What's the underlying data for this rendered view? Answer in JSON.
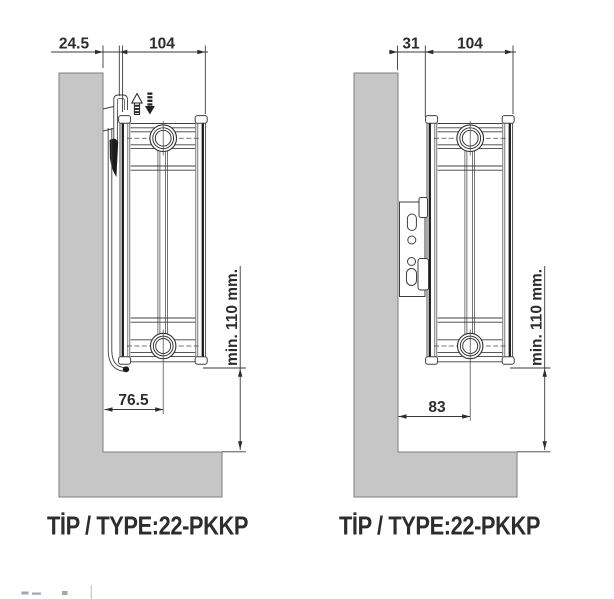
{
  "drawing": {
    "title_semantics": "Panel radiator wall-mounting side views, type 22-PKKP",
    "left": {
      "top_gap": "24.5",
      "depth": "104",
      "bottom_offset": "76.5",
      "clearance": "min. 110 mm.",
      "type_label": "TİP / TYPE:22-PKKP"
    },
    "right": {
      "top_gap": "31",
      "depth": "104",
      "bottom_offset": "83",
      "clearance": "min. 110 mm.",
      "type_label": "TİP / TYPE:22-PKKP"
    },
    "colors": {
      "wall_fill": "#c6c6c6",
      "wall_edge": "#7d7d7d",
      "line": "#3f3f3f",
      "text": "#2d2d2d"
    }
  }
}
